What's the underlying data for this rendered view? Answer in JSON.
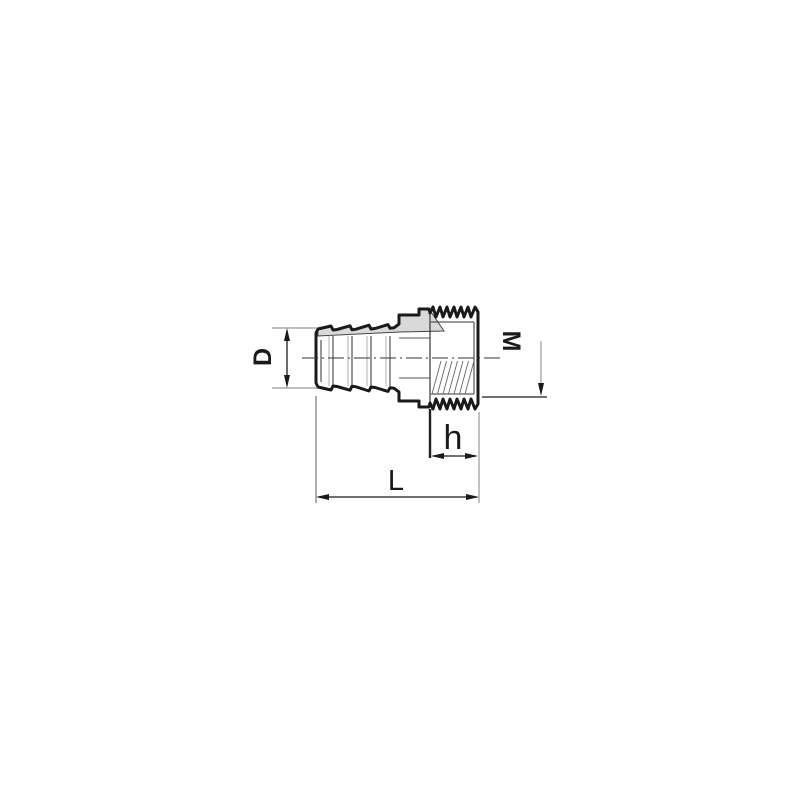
{
  "drawing": {
    "dimensions": {
      "hose_diameter": {
        "label": "D"
      },
      "thread_size": {
        "label": "M"
      },
      "thread_length": {
        "label": "h"
      },
      "overall_length": {
        "label": "L"
      }
    },
    "colors": {
      "outline": "#1a1a1a",
      "shading": "#d9d9d9",
      "extension_lines": "#999999",
      "dimension_lines": "#1a1a1a",
      "background": "#ffffff"
    }
  }
}
